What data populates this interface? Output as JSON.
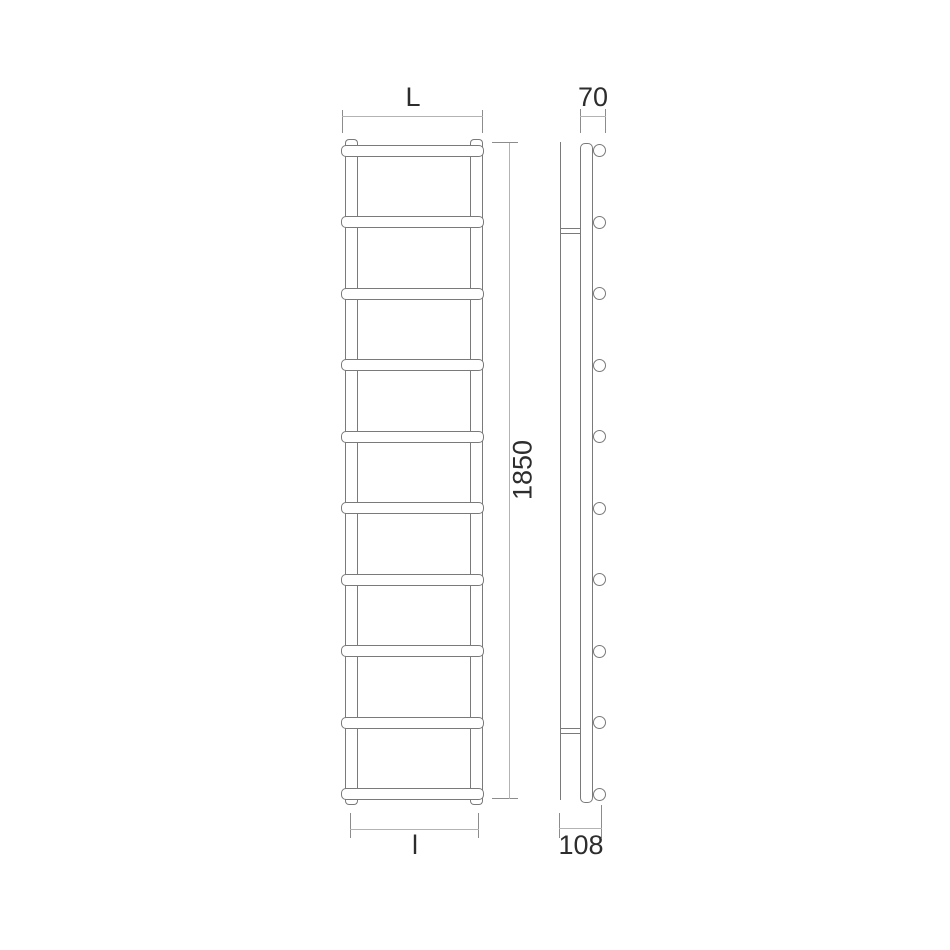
{
  "front_view": {
    "rung_count": 10,
    "width_dim": {
      "label": "L"
    },
    "height_dim": {
      "label": "1850"
    },
    "interaxis_dim": {
      "label": "l"
    }
  },
  "side_view": {
    "tube_end_count": 10,
    "wall_bracket_count": 2,
    "depth_dim": {
      "label": "70"
    },
    "overall_depth_dim": {
      "label": "108"
    }
  },
  "colors": {
    "background": "#ffffff",
    "object_line": "#7a7a7a",
    "dimension_line": "#b3b3b3",
    "tick": "#8c8c8c",
    "text": "#2d2d2d"
  }
}
